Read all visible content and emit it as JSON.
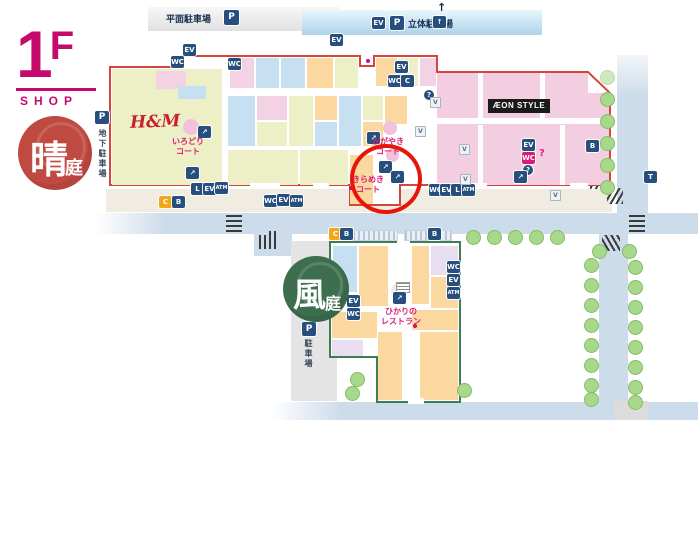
{
  "floor": {
    "number": "1F",
    "label": "SHOP"
  },
  "gardens": {
    "hare": {
      "kanji_main": "晴",
      "kanji_sub": "庭",
      "color": "#bf4a42"
    },
    "kaze": {
      "kanji_main": "風",
      "kanji_sub": "庭",
      "color": "#3d6f4f"
    }
  },
  "parking": {
    "flat_label": "平面駐車場",
    "deck_label": "立体駐車場",
    "underground_label": "地下駐車場",
    "south_label": "駐車場",
    "p_symbol": "P"
  },
  "stores": {
    "hm": "H&M",
    "aeon_style": "ÆON STYLE"
  },
  "courts": {
    "irodori": {
      "line1": "いろどり",
      "line2": "コート"
    },
    "kagayaki": {
      "line1": "かがやき",
      "line2": "コート"
    },
    "kirameki": {
      "line1": "きらめき",
      "line2": "コート"
    }
  },
  "restaurant": {
    "line1": "ひかりの",
    "line2": "レストラン"
  },
  "icons": {
    "elevator": "EV",
    "toilet": "WC",
    "escalator": "↗",
    "parking": "P",
    "atm": "ATM",
    "locker": "L",
    "info": "?",
    "bicycle": "B",
    "cart": "C",
    "vending": "V",
    "taxi": "T",
    "up_arrow": "↑"
  },
  "highlight": {
    "target_court": "きらめきコート",
    "color": "#e8150b"
  },
  "colors": {
    "floor_accent": "#c50a6b",
    "upper_building_outline": "#d6453c",
    "lower_building_outline": "#3f7d54",
    "road": "#cddcea",
    "icon_bg": "#274f7e",
    "court_text": "#d81b74",
    "hm_red": "#c8202e",
    "aeon_area_pink": "#f3cde0"
  }
}
